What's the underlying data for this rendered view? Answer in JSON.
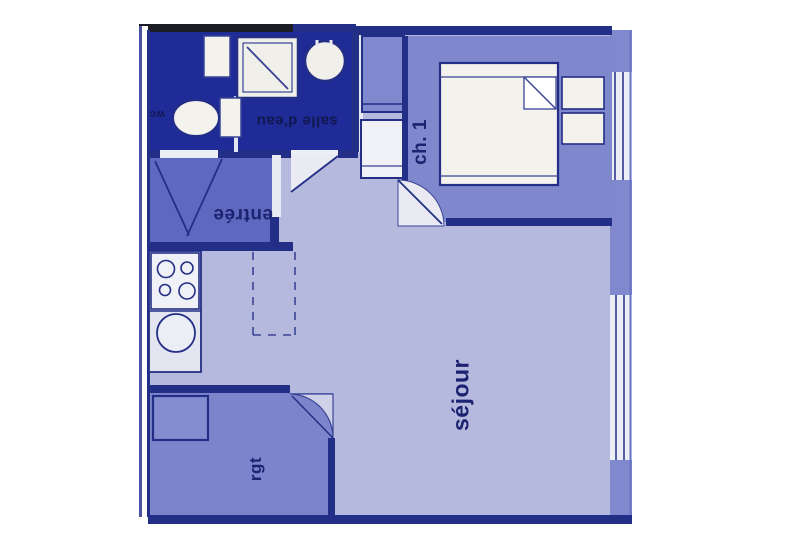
{
  "plan": {
    "type": "apartment-floor-plan",
    "rooms": {
      "salle_deau": "salle d'eau",
      "wc": "wc",
      "entree": "entrée",
      "chambre1": "ch. 1",
      "sejour": "séjour",
      "rangement": "rgt"
    },
    "fixtures": [
      "toilet",
      "washbasin-shelf",
      "shower-tray",
      "round-basin",
      "stove-4-burners",
      "kitchen-sink",
      "double-bed",
      "pillow-fold",
      "nightstand",
      "closet",
      "storage-cupboard",
      "door-swing",
      "window"
    ],
    "colors": {
      "page_bg": "#ffffff",
      "floor_light": "#b6b9de",
      "floor_medium": "#7f88cd",
      "floor_entry": "#5d68be",
      "floor_storage": "#7c85cb",
      "floor_bath_dark": "#1f2b96",
      "wall_navy": "#232e86",
      "wall_black": "#1c1d24",
      "fixture_white": "#f3f2ed",
      "window_white": "#eceef6",
      "label_navy": "#1c2370"
    }
  }
}
